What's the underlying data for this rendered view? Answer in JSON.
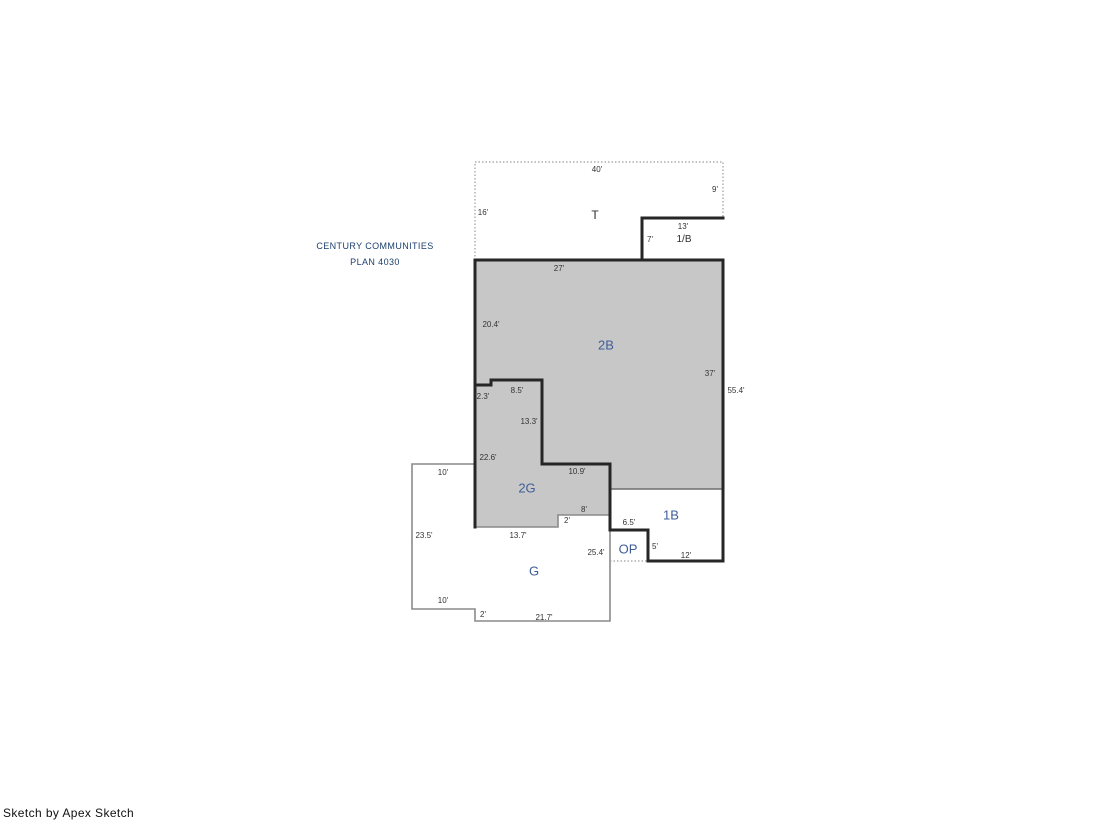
{
  "title": {
    "line1": "CENTURY COMMUNITIES",
    "line2": "PLAN 4030"
  },
  "footer": {
    "credit": "Sketch by Apex Sketch"
  },
  "colors": {
    "line_black": "#262626",
    "line_gray": "#8a8a8a",
    "dotted_gray": "#9d9d9d",
    "gray_fill": "#c7c7c7",
    "label_blue": "#3f5e99",
    "zone_dark": "#2f2f2f",
    "dim_color": "#333333",
    "title_navy": "#1c3f6e",
    "footer_black": "#111111"
  },
  "sketch": {
    "area_labels": [
      {
        "text": "2B",
        "x": 606,
        "y": 345
      },
      {
        "text": "2G",
        "x": 527,
        "y": 488
      },
      {
        "text": "G",
        "x": 534,
        "y": 571
      },
      {
        "text": "1B",
        "x": 671,
        "y": 515
      },
      {
        "text": "OP",
        "x": 628,
        "y": 549
      }
    ],
    "zone_labels": [
      {
        "text": "T",
        "x": 595,
        "y": 215,
        "cls": "t"
      },
      {
        "text": "1/B",
        "x": 684,
        "y": 240,
        "cls": "ob"
      }
    ],
    "dim_labels": [
      {
        "text": "40'",
        "x": 597,
        "y": 170
      },
      {
        "text": "9'",
        "x": 715,
        "y": 190
      },
      {
        "text": "16'",
        "x": 483,
        "y": 213
      },
      {
        "text": "13'",
        "x": 683,
        "y": 227
      },
      {
        "text": "7'",
        "x": 650,
        "y": 240
      },
      {
        "text": "27'",
        "x": 559,
        "y": 269
      },
      {
        "text": "20.4'",
        "x": 491,
        "y": 325
      },
      {
        "text": "37'",
        "x": 710,
        "y": 374
      },
      {
        "text": "55.4'",
        "x": 736,
        "y": 391
      },
      {
        "text": "2.3'",
        "x": 483,
        "y": 397
      },
      {
        "text": "8.5'",
        "x": 517,
        "y": 391
      },
      {
        "text": "13.3'",
        "x": 529,
        "y": 422
      },
      {
        "text": "22.6'",
        "x": 488,
        "y": 458
      },
      {
        "text": "10'",
        "x": 443,
        "y": 473
      },
      {
        "text": "10.9'",
        "x": 577,
        "y": 472
      },
      {
        "text": "8'",
        "x": 584,
        "y": 510
      },
      {
        "text": "2'",
        "x": 567,
        "y": 521
      },
      {
        "text": "6.5'",
        "x": 629,
        "y": 523
      },
      {
        "text": "23.5'",
        "x": 424,
        "y": 536
      },
      {
        "text": "13.7'",
        "x": 518,
        "y": 536
      },
      {
        "text": "25.4'",
        "x": 596,
        "y": 553
      },
      {
        "text": "5'",
        "x": 655,
        "y": 547
      },
      {
        "text": "12'",
        "x": 686,
        "y": 556
      },
      {
        "text": "10'",
        "x": 443,
        "y": 601
      },
      {
        "text": "2'",
        "x": 483,
        "y": 615
      },
      {
        "text": "21.7'",
        "x": 544,
        "y": 618
      }
    ]
  }
}
